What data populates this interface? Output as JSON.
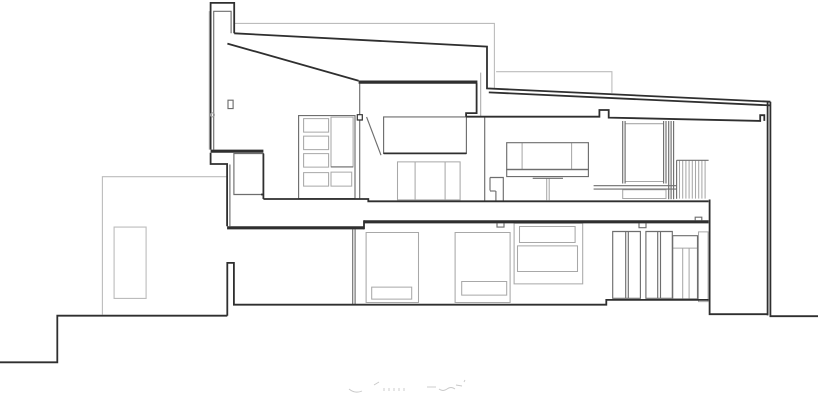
{
  "meta": {
    "drawing_type": "architectural-longitudinal-section",
    "sheet_background": "#ffffff"
  },
  "canvas": {
    "width": 818,
    "height": 404
  },
  "palette": {
    "heavy_line": "#2f2f2f",
    "mid_line": "#6e6e6e",
    "light_line": "#a8a8a8",
    "background_line": "#bcbcbc",
    "faint_caption": "#c8c8c8"
  },
  "layers": [
    {
      "name": "background-building-outlines",
      "color": "#bcbcbc",
      "width": 1.1,
      "paths": [
        "M234.4,23.4 H494.4 V88.2",
        "M496.1,71.7 H611.9 V92.9",
        "M227.1,176.7 H102.4 V314.6",
        "M114.1,227.1 H146.1 V298.4 H114.1 Z",
        "M209.3,149.6 V11.1"
      ]
    },
    {
      "name": "furniture-and-fittings-light",
      "color": "#a8a8a8",
      "width": 1.05,
      "paths": [
        "M303.6,118.6 H328.6 V132.1 H303.6 Z",
        "M303.6,136.1 H328.6 V149.6 H303.6 Z",
        "M303.6,153.6 H328.6 V167.1 H303.6 Z",
        "M303.6,172.6 H328.6 V186.1 H303.6 Z",
        "M331,117.1 H353.1 V166.9 H331 Z",
        "M331,172.1 H351.7 V186.1 H331 Z",
        "M397.5,161.9 H460.1 V199.9 H397.5 Z",
        "M415.1,161.9 V199.9",
        "M445.1,161.9 V199.9",
        "M522.1,142.7 V169.5",
        "M571.6,142.7 V169.5",
        "M546.7,178.3 V200.2",
        "M549.2,178.3 V200.2",
        "M625.1,123.7 H663.6",
        "M625.1,181.5 H663.6",
        "M622.7,189.7 H666 V198.5 H622.7 Z",
        "M679.5,160.6 V198.6",
        "M682.7,160.6 V198.6",
        "M685.9,160.6 V198.6",
        "M689.1,160.6 V198.6",
        "M692.3,160.6 V198.6",
        "M695.5,160.6 V198.6",
        "M698.7,160.6 V198.6",
        "M701.9,160.6 V198.6",
        "M705.1,160.6 V198.6",
        "M366.1,232.5 H418.5 V302.5 H366.1 Z",
        "M371.7,287.1 H411.7 V299.1 H371.7 Z",
        "M455.1,232.5 H510.1 V302.5 H455.1 Z",
        "M461.7,281.5 H506.7 V295.1 H461.7 Z",
        "M514.1,223.2 H582.7 V283.9 H514.1 Z",
        "M519.5,226.5 H575.1 V242.5 H519.5 Z",
        "M517.5,245.9 H577.5 V271.5 H517.5 Z",
        "M672.7,248.1 H697.5",
        "M682.7,248.1 V298.9",
        "M689.1,248.1 V298.9",
        "M698.5,231.9 H708.1 V301.6 H698.5 Z",
        "M480.7,72.6 V116.5"
      ]
    },
    {
      "name": "interior-walls-and-frames-mid",
      "color": "#6e6e6e",
      "width": 1.15,
      "paths": [
        "M213.7,149.6 V11.3 H231.1 V33.3",
        "M229.9,164.5 V226.2",
        "M228,100.2 H233.1 V108.6 H228 Z",
        "M233.9,153.6 H263.4 V194.5 H233.9 Z",
        "M298.6,115.6 H355 V198.6 H298.6 Z",
        "M331,166.9 H353.1",
        "M366.6,117 L381,155.2",
        "M383.6,116.9 H466.4 V153.4 H383.6 Z",
        "M359.7,83.6 V198.8",
        "M484.7,116.7 V200.8",
        "M506.7,142.7 H588.4 V169.5 H506.7 Z",
        "M506.7,169.5 H588.4 V176.6 H506.7 Z",
        "M532.7,178.3 H563",
        "M490,177.5 H503.3 V201.8",
        "M490,177.5 V190.5",
        "M490,191 H495.7",
        "M495.9,191 V201.8",
        "M622.7,121 V183.5",
        "M625.1,121 V183.5",
        "M663.6,121 V183.5",
        "M666,121 V183.5",
        "M668.7,121 V199.2",
        "M671.1,121 V199.2",
        "M673.6,121 V199.2",
        "M593.6,185.7 H676.5",
        "M593.6,189.1 H676.5",
        "M676.6,160.3 H708.6",
        "M676.6,160.3 V198.8",
        "M352.7,229.3 V304.5",
        "M355.1,229.3 V304.5",
        "M612.7,231.5 H640.4 V298.3 H612.7 Z",
        "M625.7,231.5 V298.3",
        "M628.3,231.5 V298.3",
        "M645.9,231.5 H672.3 V298.3 H645.9 Z",
        "M657.7,231.5 V298.3",
        "M660.5,231.5 V298.3",
        "M672.7,235.7 H697.5 V298.9 H672.7 Z",
        "M497,223.2 V227.1 H504 V223.2",
        "M639,223.2 V227.7 H646 V223.2",
        "M695.2,220.3 V217.2 H701.8 V220.3"
      ]
    },
    {
      "name": "section-structure-heavy",
      "color": "#2f2f2f",
      "width": 1.8,
      "paths": [
        "M210.6,149.6 V2.9 H234.2 V33.3",
        "M234.2,33.3 L487,46.6 V88.4 L770.4,101.7",
        "M488.8,92.4 L770.4,105.4",
        "M227.4,43.6 L358.6,80.7",
        "M476.6,83.2 V113.1 H466.1 V116.7",
        "M466.1,116.7 H599.4 V110 H608.7 V117.6 L760.2,120.9 V115.2 H764.3 V120.9",
        "M210.6,152.8 V164 H227.1 V226.2",
        "M263.4,199 H368.3 V201.3 H708.6",
        "M364,229.3 V220.3",
        "M227.3,315.7 V262.9 H233.9 V304.7 H606.3 V299.9 H708.6",
        "M0,362.3 H57.3 V315.7 H227.3",
        "M709.6,199.5 V314.2 H767.6",
        "M767.6,101.9 V315.4",
        "M770.4,101.7 V316.2 H818",
        "M383.6,153.4 H466.4",
        "M263.4,153.6 V199",
        "M261.1,194.5 H263.4"
      ]
    },
    {
      "name": "slab-bands-heavy",
      "color": "#2f2f2f",
      "width": 3.2,
      "paths": [
        "M210.6,151.2 H263.4",
        "M227.1,227.8 H364",
        "M364,221.8 H708.6",
        "M358.6,82.1 H477.4"
      ]
    },
    {
      "name": "section-markers",
      "color": "#2f2f2f",
      "width": 1.2,
      "fill": "#ffffff",
      "paths": [
        "M357.3,114.7 H362.3 V120 H357.3 Z"
      ]
    },
    {
      "name": "caption-marks",
      "color": "#c8c8c8",
      "width": 0.9,
      "paths": [
        "M349,389 q6,5 13,2",
        "M374,385 l5,-3",
        "M384,388 v3 M389,388 v3 M394,388 v3 M399,388 v3 M404,388 v3",
        "M427,387 h9",
        "M439,389 q4,3 8,0 t8,0",
        "M456,385 l6,1",
        "M464,382 l1,-2"
      ]
    }
  ],
  "circles": [
    {
      "name": "wall-joint-marker",
      "cx": 212.4,
      "cy": 114.9,
      "r": 2.0,
      "color": "#9a9a9a",
      "width": 1.0
    }
  ]
}
